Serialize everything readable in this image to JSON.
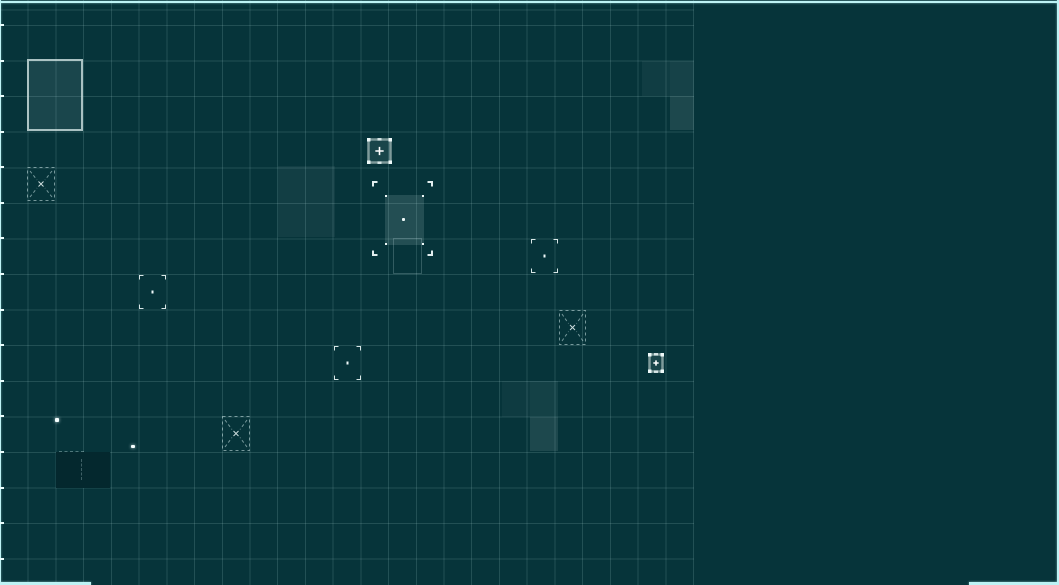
{
  "scene": {
    "name": "strategy-grid-map",
    "width": 1059,
    "height": 585,
    "colors": {
      "background": "#06343a",
      "grid_line": "rgba(173,216,216,0.17)",
      "viewport_border": "#bdf3f5",
      "marker_bright": "#eef9f9",
      "marker_dim": "rgba(210,235,235,0.55)",
      "plus_frame": "#7e9a9a",
      "structure_border": "rgba(205,224,224,0.8)",
      "highlight_fill": "216,238,238",
      "dark_patch": "#04282e"
    },
    "grid": {
      "area_width": 694,
      "area_height": 585,
      "cell_width": 27.72,
      "cell_height": 35.58,
      "first_row_y": 25,
      "columns": 25,
      "rows": 16
    }
  },
  "viewport_border_segments": [
    {
      "id": "top",
      "x": 0,
      "y": 1,
      "w": 1059,
      "h": 2
    },
    {
      "id": "left",
      "x": 0,
      "y": 0,
      "w": 1,
      "h": 585
    },
    {
      "id": "right",
      "x": 1057,
      "y": 0,
      "w": 2,
      "h": 585
    },
    {
      "id": "bottom-left",
      "x": 0,
      "y": 582,
      "w": 91,
      "h": 3
    },
    {
      "id": "bottom-right",
      "x": 969,
      "y": 582,
      "w": 90,
      "h": 3
    }
  ],
  "highlight_cells": [
    {
      "x": 278,
      "y": 166,
      "w": 57,
      "h": 71,
      "opacity": 0.06
    },
    {
      "x": 642,
      "y": 61,
      "w": 28,
      "h": 35,
      "opacity": 0.05
    },
    {
      "x": 670,
      "y": 61,
      "w": 24,
      "h": 35,
      "opacity": 0.08
    },
    {
      "x": 670,
      "y": 96,
      "w": 24,
      "h": 34,
      "opacity": 0.11
    },
    {
      "x": 502,
      "y": 381,
      "w": 28,
      "h": 36,
      "opacity": 0.045
    },
    {
      "x": 530,
      "y": 381,
      "w": 28,
      "h": 36,
      "opacity": 0.07
    },
    {
      "x": 530,
      "y": 417,
      "w": 28,
      "h": 34,
      "opacity": 0.11
    }
  ],
  "structures": [
    {
      "x": 27,
      "y": 59,
      "w": 56,
      "h": 72
    }
  ],
  "plus_markers": [
    {
      "x": 367,
      "y": 138,
      "w": 25,
      "h": 26
    },
    {
      "x": 648,
      "y": 353,
      "w": 16,
      "h": 20
    }
  ],
  "unit_markers": [
    {
      "x": 139,
      "y": 275,
      "w": 27,
      "h": 34
    },
    {
      "x": 334,
      "y": 346,
      "w": 27,
      "h": 34
    },
    {
      "x": 531,
      "y": 239,
      "w": 27,
      "h": 34
    }
  ],
  "x_markers": [
    {
      "x": 27,
      "y": 167,
      "w": 28,
      "h": 34
    },
    {
      "x": 559,
      "y": 310,
      "w": 27,
      "h": 35
    },
    {
      "x": 222,
      "y": 416,
      "w": 28,
      "h": 35
    }
  ],
  "selection": {
    "marquee": {
      "x": 372,
      "y": 181,
      "w": 61,
      "h": 75
    },
    "ghost": {
      "x": 393,
      "y": 238,
      "w": 29,
      "h": 36
    },
    "fill": {
      "x": 385,
      "y": 195,
      "w": 39,
      "h": 50
    },
    "dot": {
      "x": 402,
      "y": 218,
      "w": 3,
      "h": 3
    }
  },
  "sparks": [
    {
      "x": 55,
      "y": 418,
      "w": 4,
      "h": 4
    },
    {
      "x": 131,
      "y": 445,
      "w": 4,
      "h": 3
    }
  ],
  "dark_patch": {
    "x": 56,
    "y": 452,
    "w": 54,
    "h": 36
  },
  "patch_dashes": [
    {
      "dir": "h",
      "x": 59,
      "y": 451,
      "w": 25,
      "h": 2
    },
    {
      "dir": "v",
      "x": 81,
      "y": 459,
      "w": 2,
      "h": 21
    }
  ]
}
